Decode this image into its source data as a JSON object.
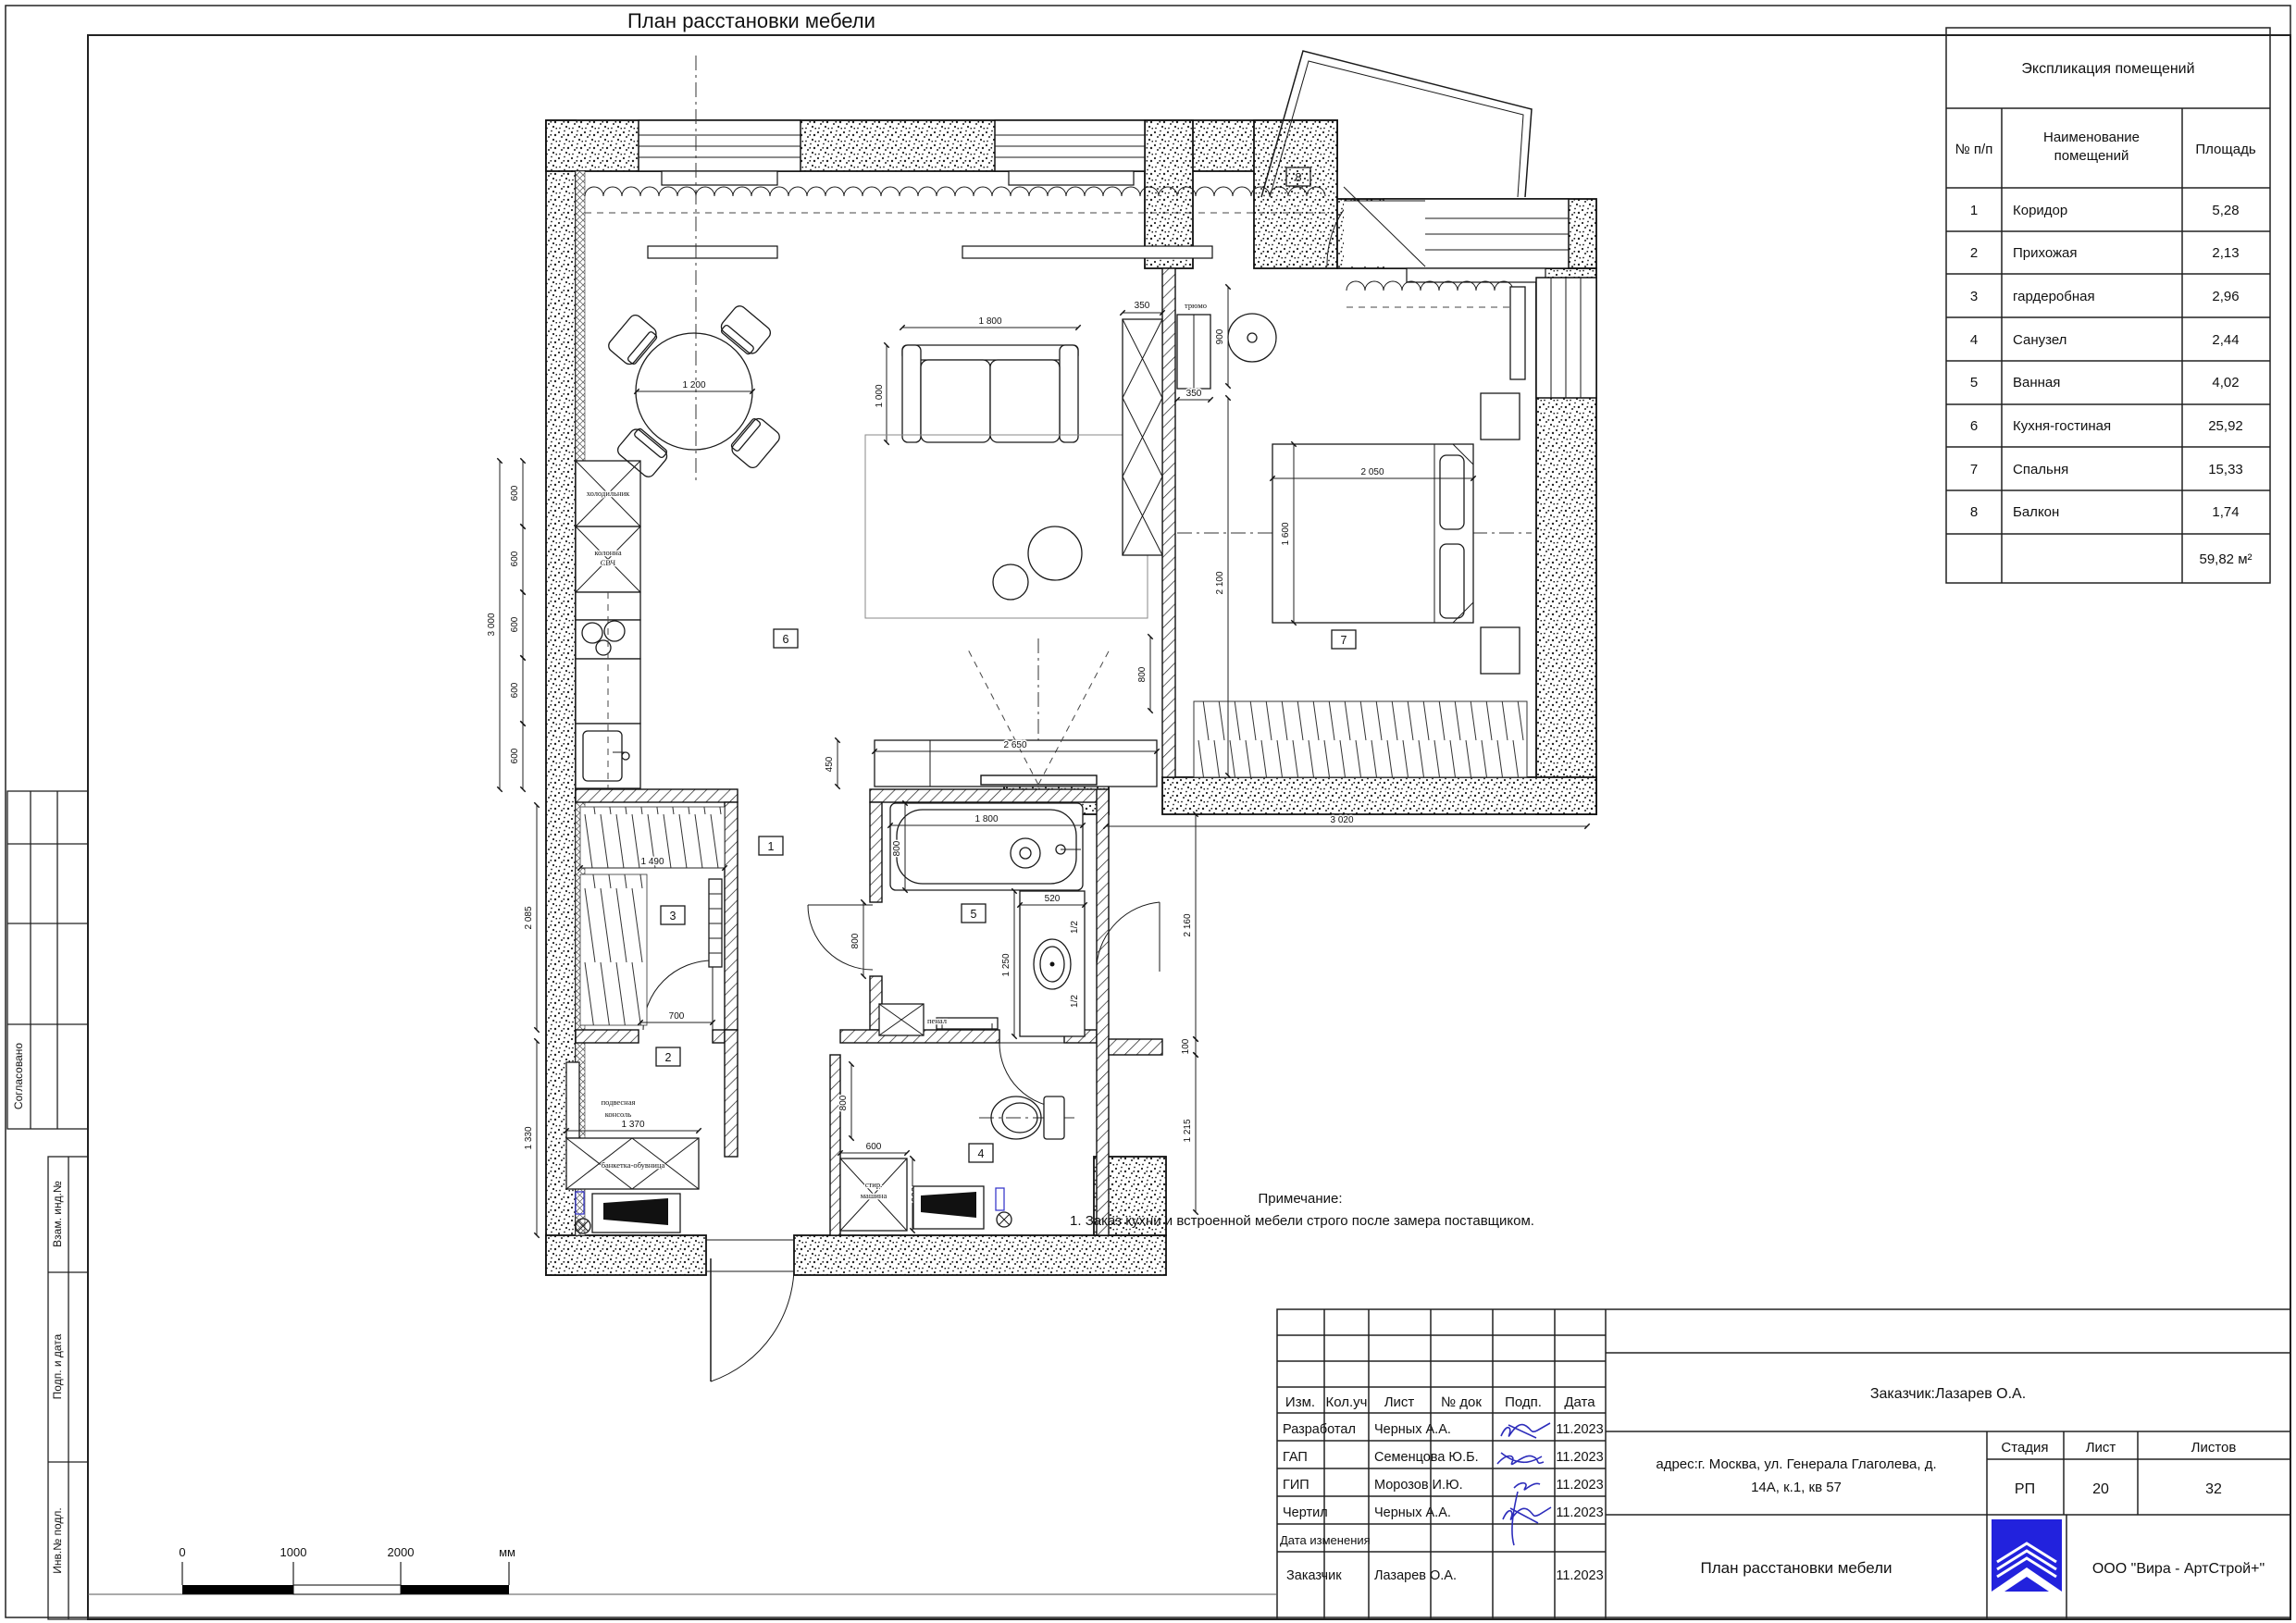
{
  "sheet": {
    "title": "План расстановки мебели",
    "scale_bar": {
      "t0": "0",
      "t1": "1000",
      "t2": "2000",
      "unit": "мм"
    },
    "side_labels": {
      "agreed": "Согласовано",
      "vzam": "Взам. инд.№",
      "podp_data": "Подп. и дата",
      "inv": "Инв.№ подл."
    }
  },
  "explication": {
    "title": "Экспликация помещений",
    "col_num": "№ п/п",
    "col_name1": "Наименование",
    "col_name2": "помещений",
    "col_area": "Площадь",
    "rows": [
      {
        "n": "1",
        "name": "Коридор",
        "area": "5,28"
      },
      {
        "n": "2",
        "name": "Прихожая",
        "area": "2,13"
      },
      {
        "n": "3",
        "name": "гардеробная",
        "area": "2,96"
      },
      {
        "n": "4",
        "name": "Санузел",
        "area": "2,44"
      },
      {
        "n": "5",
        "name": "Ванная",
        "area": "4,02"
      },
      {
        "n": "6",
        "name": "Кухня-гостиная",
        "area": "25,92"
      },
      {
        "n": "7",
        "name": "Спальня",
        "area": "15,33"
      },
      {
        "n": "8",
        "name": "Балкон",
        "area": "1,74"
      }
    ],
    "total": "59,82 м²"
  },
  "note": {
    "title": "Примечание:",
    "line1": "1. Заказ кухни и встроенной мебели строго после замера поставщиком."
  },
  "stamp": {
    "h_izm": "Изм.",
    "h_kol": "Кол.уч",
    "h_list": "Лист",
    "h_dok": "№ док",
    "h_podp": "Подп.",
    "h_data": "Дата",
    "rows": [
      {
        "role": "Разработал",
        "name": "Черных А.А.",
        "date": "11.2023"
      },
      {
        "role": "ГАП",
        "name": "Семенцова Ю.Б.",
        "date": "11.2023"
      },
      {
        "role": "ГИП",
        "name": "Морозов И.Ю.",
        "date": "11.2023"
      },
      {
        "role": "Чертил",
        "name": "Черных А.А.",
        "date": "11.2023"
      },
      {
        "role": "Дата изменения",
        "name": "",
        "date": ""
      },
      {
        "role": "Заказчик",
        "name": "Лазарев О.А.",
        "date": "11.2023"
      }
    ],
    "customer": "Заказчик:Лазарев О.А.",
    "address_line1": "адрес:г. Москва, ул. Генерала Глаголева, д.",
    "address_line2": "14А, к.1, кв 57",
    "stage_label": "Стадия",
    "list_label": "Лист",
    "listov_label": "Листов",
    "stage": "РП",
    "list_no": "20",
    "listov": "32",
    "doc_title": "План расстановки мебели",
    "company": "ООО \"Вира - АртСтрой+\""
  },
  "plan": {
    "rooms": {
      "r1": "1",
      "r2": "2",
      "r3": "3",
      "r4": "4",
      "r5": "5",
      "r6": "6",
      "r7": "7",
      "r8": "8"
    },
    "labels": {
      "fridge": "холодильник",
      "col1": "колонна",
      "col2": "СВЧ",
      "tryumo": "трюмо",
      "penal": "пенал",
      "wash1": "стир.",
      "wash2": "машина",
      "bench": "банкетка-обувница",
      "console1": "подвесная",
      "console2": "консоль"
    },
    "dims": {
      "d1200": "1 200",
      "d1800": "1 800",
      "d1000": "1 000",
      "d600": "600",
      "d3000": "3 000",
      "d350": "350",
      "d900": "900",
      "d2100": "2 100",
      "d2050": "2 050",
      "d1600": "1 600",
      "d3020": "3 020",
      "d2650": "2 650",
      "d450": "450",
      "d800": "800",
      "d1490": "1 490",
      "d700": "700",
      "d2085": "2 085",
      "d1330": "1 330",
      "d1370": "1 370",
      "d520": "520",
      "d1250": "1 250",
      "d2160": "2 160",
      "d100": "100",
      "d1215": "1 215",
      "dhalf": "1/2"
    }
  }
}
